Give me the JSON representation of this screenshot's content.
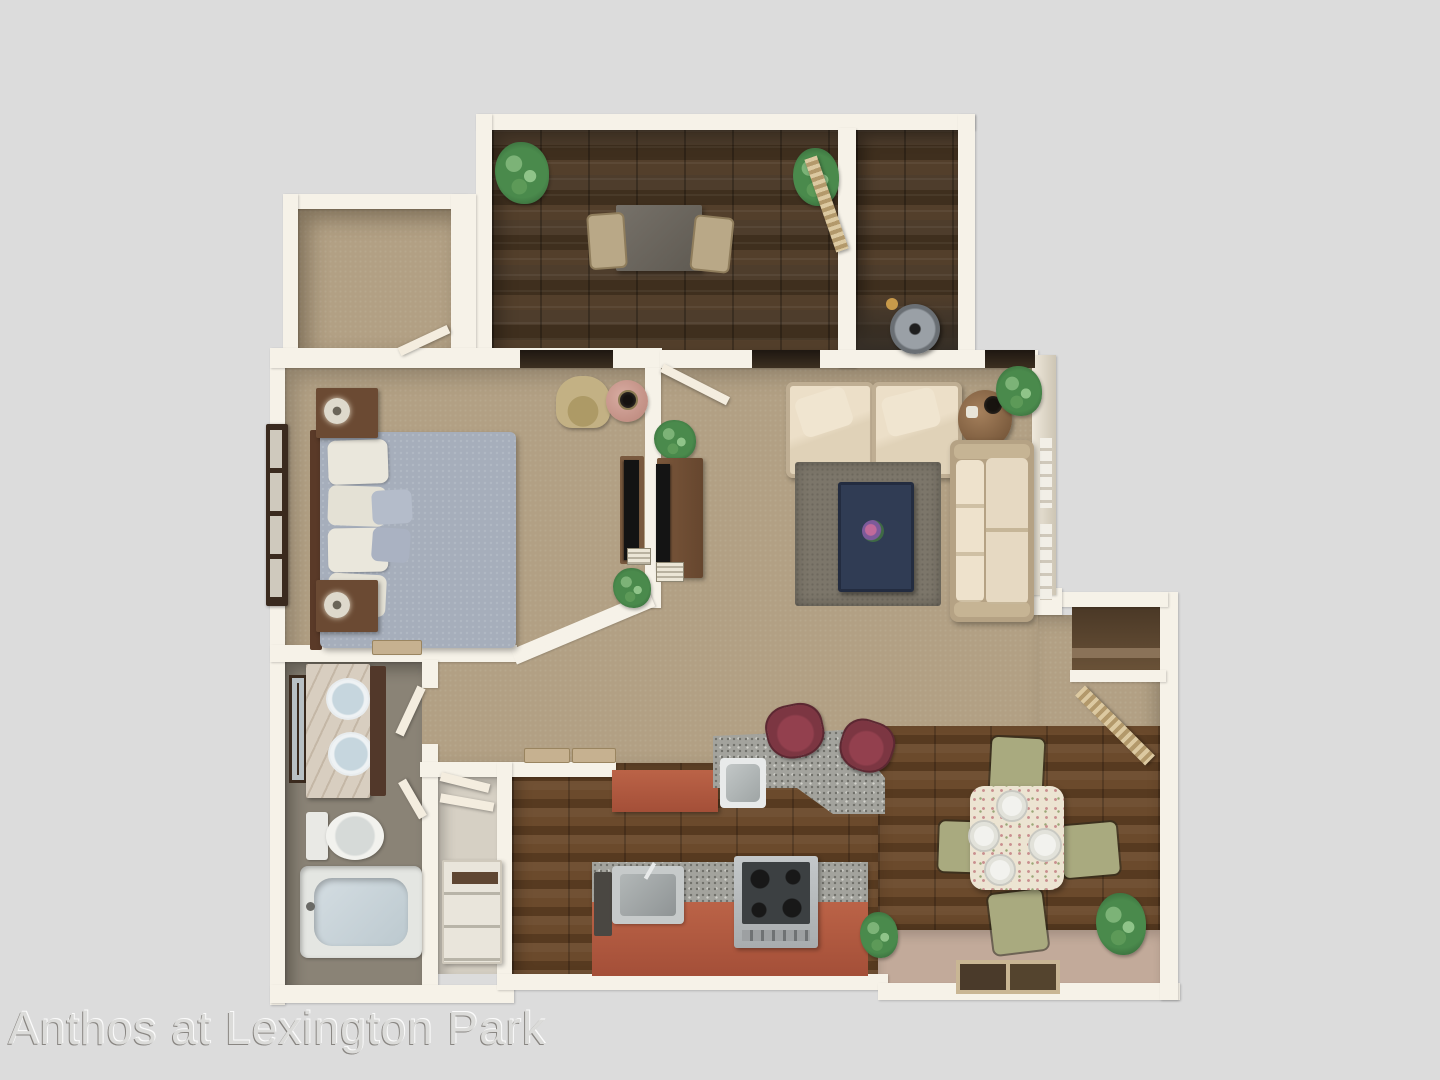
{
  "watermark": {
    "text": "Anthos at Lexington Park"
  },
  "plan": {
    "type": "3d-floor-plan-top-view",
    "rooms": [
      "den",
      "storage-utility-room",
      "walk-in-closet",
      "bedroom",
      "living-room",
      "hallway",
      "bathroom",
      "linen-closet",
      "kitchen",
      "dining-area",
      "entry-closet"
    ]
  },
  "colors": {
    "background": "#dcdcdc",
    "wall": "#f6f2e8",
    "carpet": "#b2a084",
    "den_wood": "#483828",
    "kitchen_wood": "#5f432a",
    "dining_strip": "#c2aa9a",
    "bathroom_floor": "#8a8376",
    "granite": "#a3a39d",
    "cabinet_terracotta": "#a44f38",
    "bed": "#a6aebb",
    "sofa_cream": "#e6d9c2",
    "rug": "#7c766a",
    "coffee_table": "#303c54",
    "dining_chair": "#a9aa7f",
    "plant": "#4a8a4c",
    "wood_furniture": "#6b4a33",
    "stool_maroon": "#7c3642",
    "watermark_text": "#dbdbd9"
  }
}
